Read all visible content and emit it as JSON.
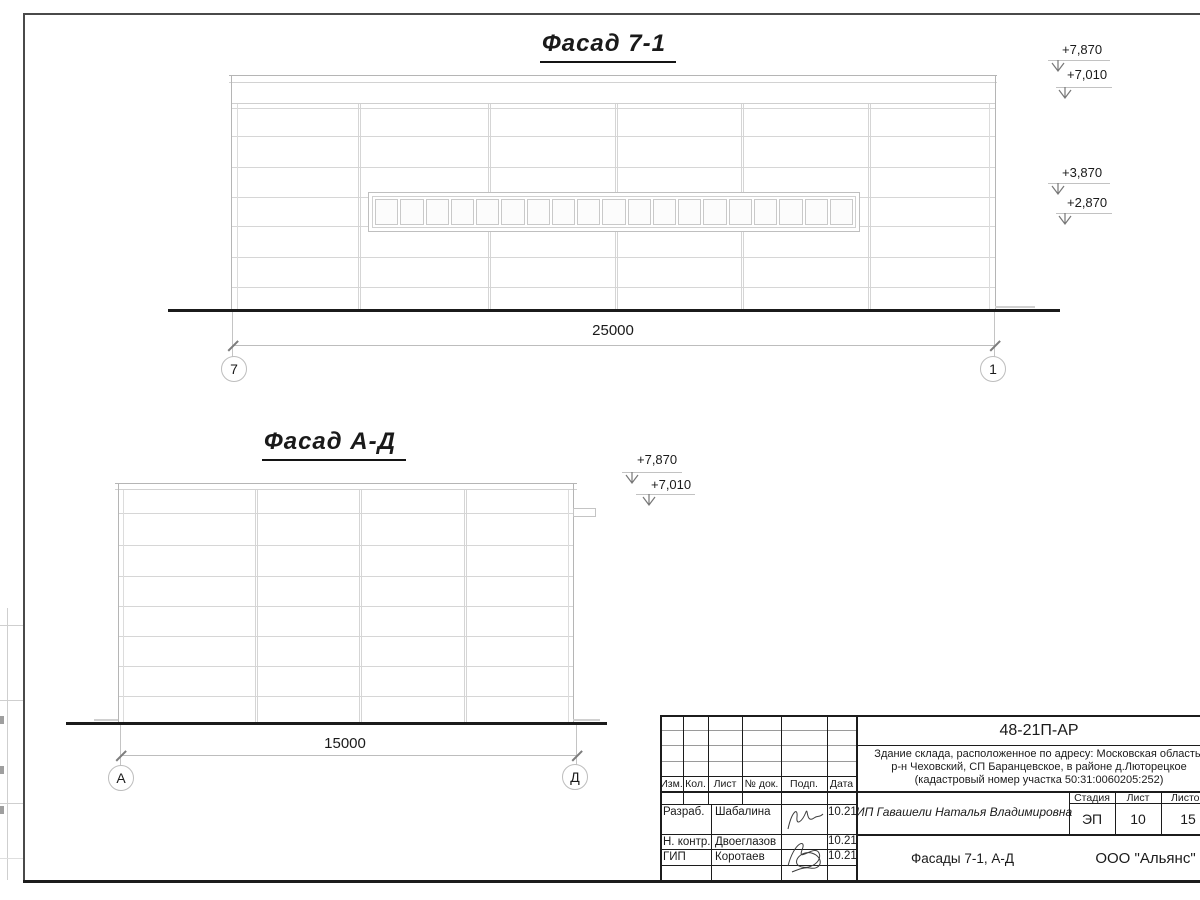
{
  "facade_7_1": {
    "title": "Фасад 7-1",
    "dimension": "25000",
    "axes": [
      "7",
      "1"
    ],
    "levels": {
      "parapet": "+7,870",
      "roof": "+7,010",
      "window_top": "+3,870",
      "window_bottom": "+2,870"
    },
    "window_panes": 19
  },
  "facade_a_d": {
    "title": "Фасад А-Д",
    "dimension": "15000",
    "axes": [
      "А",
      "Д"
    ],
    "levels": {
      "parapet": "+7,870",
      "roof": "+7,010"
    }
  },
  "title_block": {
    "doc_number": "48-21П-АР",
    "project_line1": "Здание склада, расположенное по адресу: Московская область,",
    "project_line2": "р-н Чеховский, СП Баранцевское, в районе д.Люторецкое",
    "project_line3": "(кадастровый номер участка 50:31:0060205:252)",
    "columns": [
      "Изм.",
      "Кол.",
      "Лист",
      "№ док.",
      "Подп.",
      "Дата"
    ],
    "signers": [
      {
        "role": "Разраб.",
        "name": "Шабалина",
        "date": "10.21"
      },
      {
        "role": "Н. контр.",
        "name": "Двоеглазов",
        "date": "10.21"
      },
      {
        "role": "ГИП",
        "name": "Коротаев",
        "date": "10.21"
      }
    ],
    "client": "ИП Гавашели Наталья Владимировна",
    "stage_label": "Стадия",
    "stage": "ЭП",
    "sheet_label": "Лист",
    "sheet": "10",
    "total_label": "Листов",
    "total": "15",
    "sheet_title": "Фасады 7-1, А-Д",
    "company": "ООО \"Альянс\""
  }
}
